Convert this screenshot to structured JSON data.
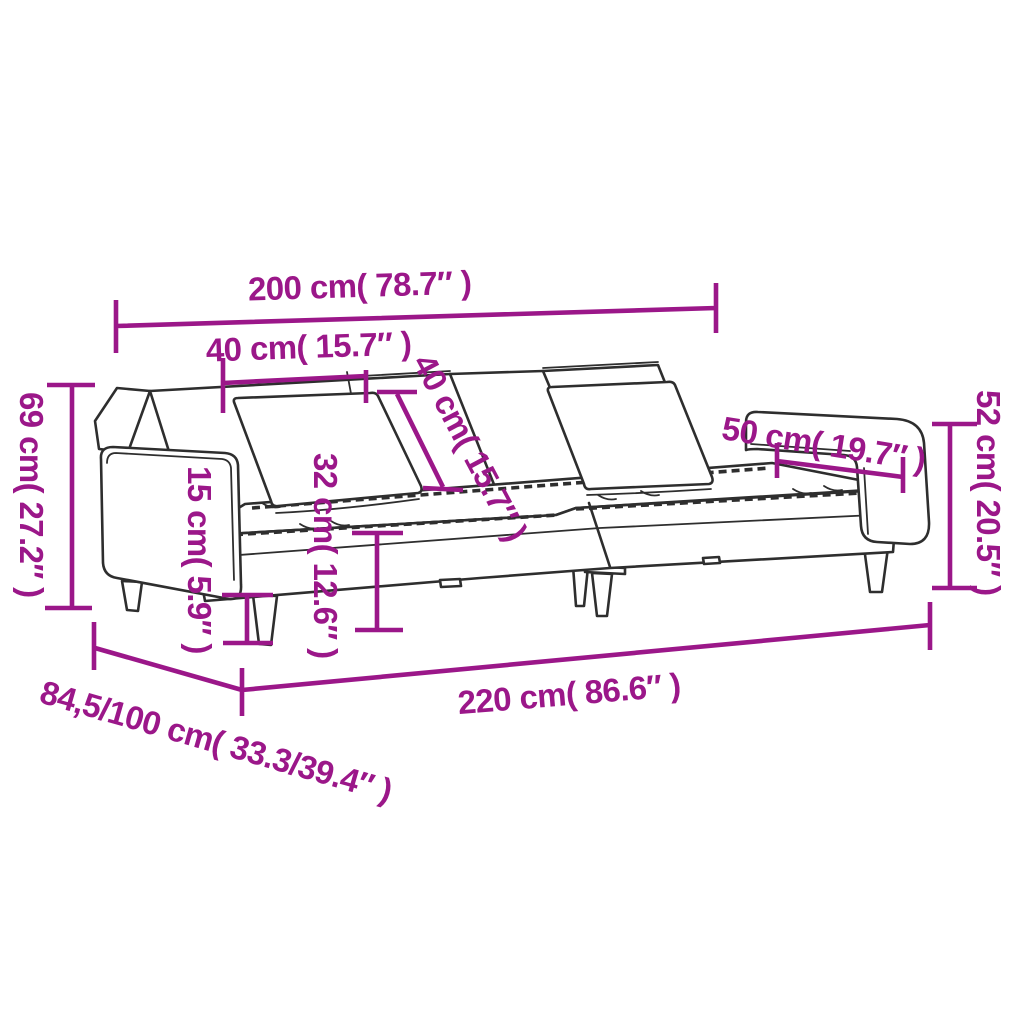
{
  "page": {
    "type": "product-dimension-diagram",
    "product": "sofa-bed-with-two-pillows",
    "background": "#ffffff"
  },
  "style": {
    "dimension_color": "#9B1789",
    "line_art_color": "#2e2e2e"
  },
  "dims": {
    "inner_width": {
      "label": "200 cm( 78.7″ )"
    },
    "back_section": {
      "label": "40 cm( 15.7″ )"
    },
    "pillow": {
      "label": "40 cm( 15.7″ )"
    },
    "total_height": {
      "label": "69 cm( 27.2″ )"
    },
    "leg_height": {
      "label": "15 cm( 5.9″ )"
    },
    "seat_height": {
      "label": "32 cm( 12.6″ )"
    },
    "armrest_length": {
      "label": "50 cm( 19.7″ )"
    },
    "armrest_height": {
      "label": "52 cm( 20.5″ )"
    },
    "total_width": {
      "label": "220 cm( 86.6″ )"
    },
    "depth_range": {
      "label": "84,5/100 cm( 33.3/39.4″ )"
    }
  }
}
